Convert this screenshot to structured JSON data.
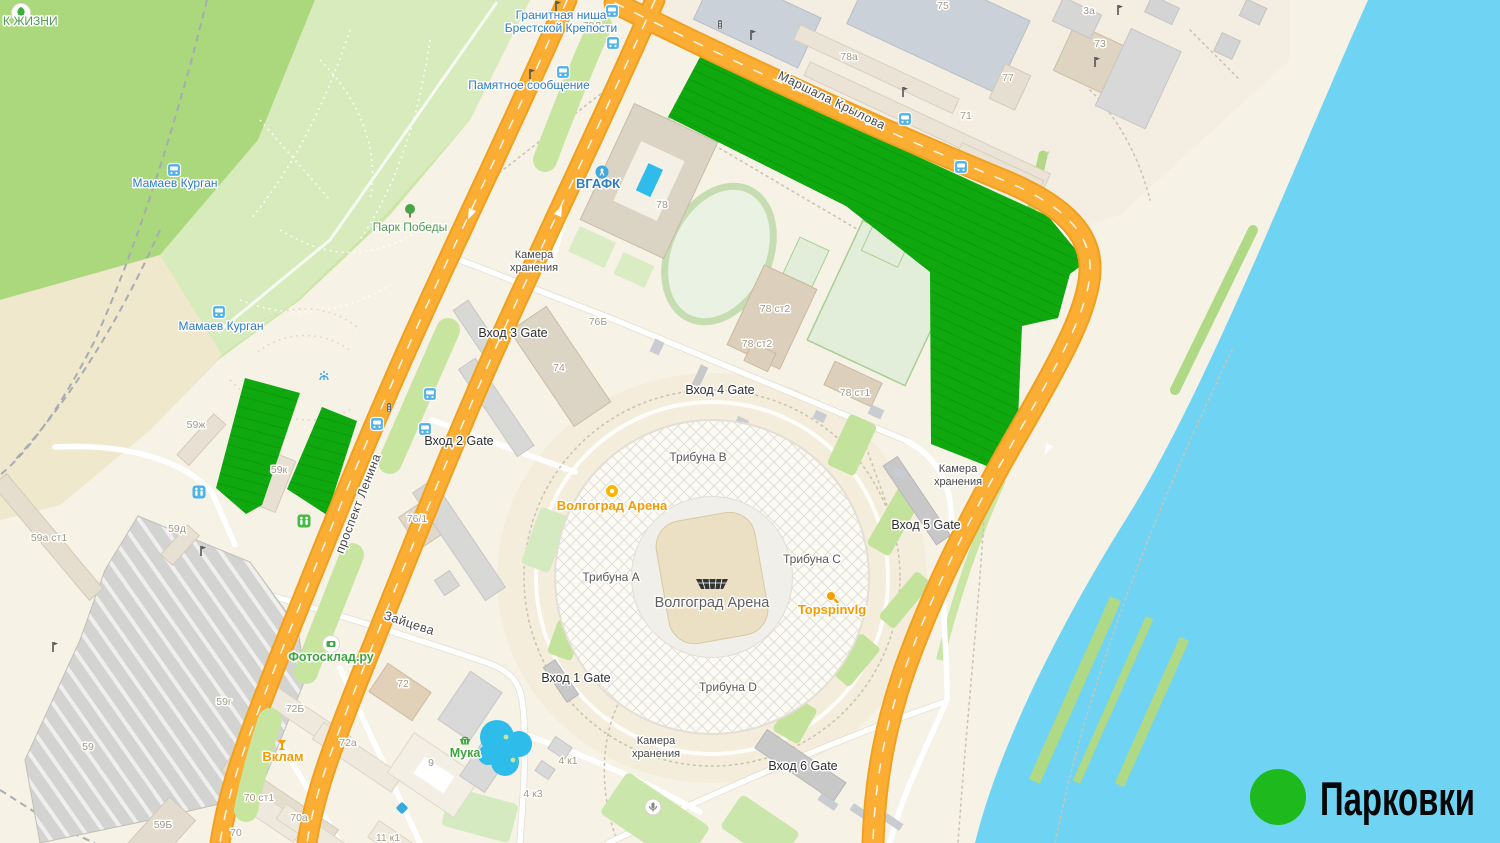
{
  "legend": {
    "label": "Парковки",
    "swatch_color": "#1DB91D"
  },
  "colors": {
    "water": "#6FD3F3",
    "road": "#FBAE33",
    "road_edge": "#EFA01F",
    "parking_green": "#0FA90F",
    "parking_stripe": "#0B970B",
    "park_dark": "#ABD87C",
    "park_light": "#D7EBBD",
    "land": "#F7F2E6"
  },
  "stadium": {
    "name": "Волгоград Арена"
  },
  "labels": {
    "streets": [
      {
        "text": "Маршала Крылова",
        "x": 830,
        "y": 104,
        "angle": 26
      },
      {
        "text": "проспект Ленина",
        "x": 362,
        "y": 505,
        "angle": -69
      },
      {
        "text": "Зайцева",
        "x": 408,
        "y": 627,
        "angle": 18
      }
    ],
    "gates": [
      {
        "text": "Вход 1 Gate",
        "x": 576,
        "y": 682
      },
      {
        "text": "Вход 2 Gate",
        "x": 459,
        "y": 445
      },
      {
        "text": "Вход 3 Gate",
        "x": 513,
        "y": 337
      },
      {
        "text": "Вход 4 Gate",
        "x": 720,
        "y": 394
      },
      {
        "text": "Вход 5 Gate",
        "x": 926,
        "y": 529
      },
      {
        "text": "Вход 6 Gate",
        "x": 803,
        "y": 770
      }
    ],
    "stands": [
      {
        "text": "Трибуна A",
        "x": 611,
        "y": 581
      },
      {
        "text": "Трибуна B",
        "x": 698,
        "y": 461
      },
      {
        "text": "Трибуна C",
        "x": 812,
        "y": 563
      },
      {
        "text": "Трибуна D",
        "x": 728,
        "y": 691
      }
    ],
    "storage": {
      "line1": "Камера",
      "line2": "хранения",
      "positions": [
        {
          "x": 534,
          "y": 258
        },
        {
          "x": 958,
          "y": 472
        },
        {
          "x": 656,
          "y": 744
        }
      ]
    },
    "buildings": [
      {
        "text": "75",
        "x": 943,
        "y": 9
      },
      {
        "text": "78а",
        "x": 849,
        "y": 60
      },
      {
        "text": "71",
        "x": 966,
        "y": 119
      },
      {
        "text": "77",
        "x": 1008,
        "y": 81
      },
      {
        "text": "73",
        "x": 1100,
        "y": 47
      },
      {
        "text": "3а",
        "x": 1089,
        "y": 14
      },
      {
        "text": "78Л",
        "x": 592,
        "y": 29
      },
      {
        "text": "78",
        "x": 662,
        "y": 208
      },
      {
        "text": "74",
        "x": 559,
        "y": 371
      },
      {
        "text": "76Б",
        "x": 598,
        "y": 325
      },
      {
        "text": "76/1",
        "x": 417,
        "y": 522
      },
      {
        "text": "78 ст2",
        "x": 775,
        "y": 312
      },
      {
        "text": "78 ст2",
        "x": 757,
        "y": 347
      },
      {
        "text": "78 ст1",
        "x": 855,
        "y": 396
      },
      {
        "text": "59ж",
        "x": 196,
        "y": 428
      },
      {
        "text": "59к",
        "x": 279,
        "y": 473
      },
      {
        "text": "59д",
        "x": 177,
        "y": 532
      },
      {
        "text": "59а ст1",
        "x": 49,
        "y": 541
      },
      {
        "text": "59",
        "x": 88,
        "y": 750
      },
      {
        "text": "59г",
        "x": 224,
        "y": 705
      },
      {
        "text": "59Б",
        "x": 163,
        "y": 828
      },
      {
        "text": "72Б",
        "x": 295,
        "y": 712
      },
      {
        "text": "72а",
        "x": 348,
        "y": 746
      },
      {
        "text": "72",
        "x": 403,
        "y": 687
      },
      {
        "text": "9",
        "x": 431,
        "y": 766
      },
      {
        "text": "70 ст1",
        "x": 259,
        "y": 801
      },
      {
        "text": "70а",
        "x": 299,
        "y": 821
      },
      {
        "text": "70",
        "x": 236,
        "y": 836
      },
      {
        "text": "11 к1",
        "x": 388,
        "y": 841
      },
      {
        "text": "4 к1",
        "x": 568,
        "y": 764
      },
      {
        "text": "4 к3",
        "x": 533,
        "y": 797
      }
    ]
  },
  "poi": {
    "arena": {
      "label": "Волгоград Арена"
    },
    "topspin": {
      "label": "Topspinvlg"
    },
    "vklam": {
      "label": "Вклам"
    },
    "fotosklad": {
      "label": "Фотосклад.ру"
    },
    "muka": {
      "label": "Мука"
    },
    "vgafk": {
      "label": "ВГАФК"
    },
    "mamaev1": {
      "label": "Мамаев Курган"
    },
    "mamaev2": {
      "label": "Мамаев Курган"
    },
    "pamyatnoe": {
      "label": "Памятное сообщение"
    },
    "granit1": {
      "label": "Гранитная ниша"
    },
    "granit2": {
      "label": "Брестской Крепости"
    },
    "park_pobedy": {
      "label": "Парк Победы"
    },
    "park_zhizni": {
      "label": "К ЖИЗНИ"
    }
  },
  "icons": {
    "bus_stops": [
      {
        "x": 612,
        "y": 11
      },
      {
        "x": 613,
        "y": 43
      },
      {
        "x": 563,
        "y": 72
      },
      {
        "x": 905,
        "y": 119
      },
      {
        "x": 961,
        "y": 167
      },
      {
        "x": 430,
        "y": 394
      },
      {
        "x": 377,
        "y": 424
      },
      {
        "x": 425,
        "y": 429
      },
      {
        "x": 219,
        "y": 312
      },
      {
        "x": 174,
        "y": 170
      }
    ],
    "monuments": [
      {
        "x": 556,
        "y": 6
      },
      {
        "x": 530,
        "y": 74
      },
      {
        "x": 751,
        "y": 35
      },
      {
        "x": 1118,
        "y": 10
      },
      {
        "x": 1095,
        "y": 62
      },
      {
        "x": 201,
        "y": 551
      },
      {
        "x": 53,
        "y": 647
      },
      {
        "x": 903,
        "y": 92
      }
    ],
    "traffic_lights": [
      {
        "x": 720,
        "y": 25
      },
      {
        "x": 389,
        "y": 408
      }
    ]
  }
}
